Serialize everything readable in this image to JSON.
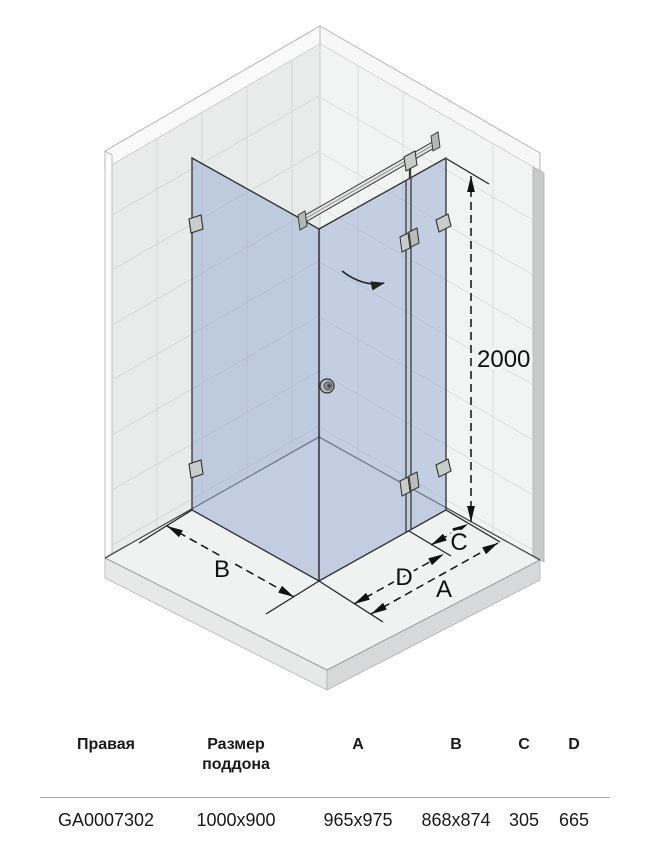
{
  "diagram": {
    "labels": {
      "height": "2000",
      "width_b": "B",
      "width_d": "D",
      "width_a": "A",
      "width_c": "C"
    },
    "colors": {
      "glass": "#94aad2",
      "wall_left": "#e9eaea",
      "wall_right": "#f2f3f3",
      "tray_top": "#f0f1f1",
      "dimension_line": "#111111"
    }
  },
  "table": {
    "headers": [
      "Правая",
      "Размер поддона",
      "A",
      "B",
      "C",
      "D"
    ],
    "row": [
      "GA0007302",
      "1000x900",
      "965x975",
      "868x874",
      "305",
      "665"
    ]
  }
}
